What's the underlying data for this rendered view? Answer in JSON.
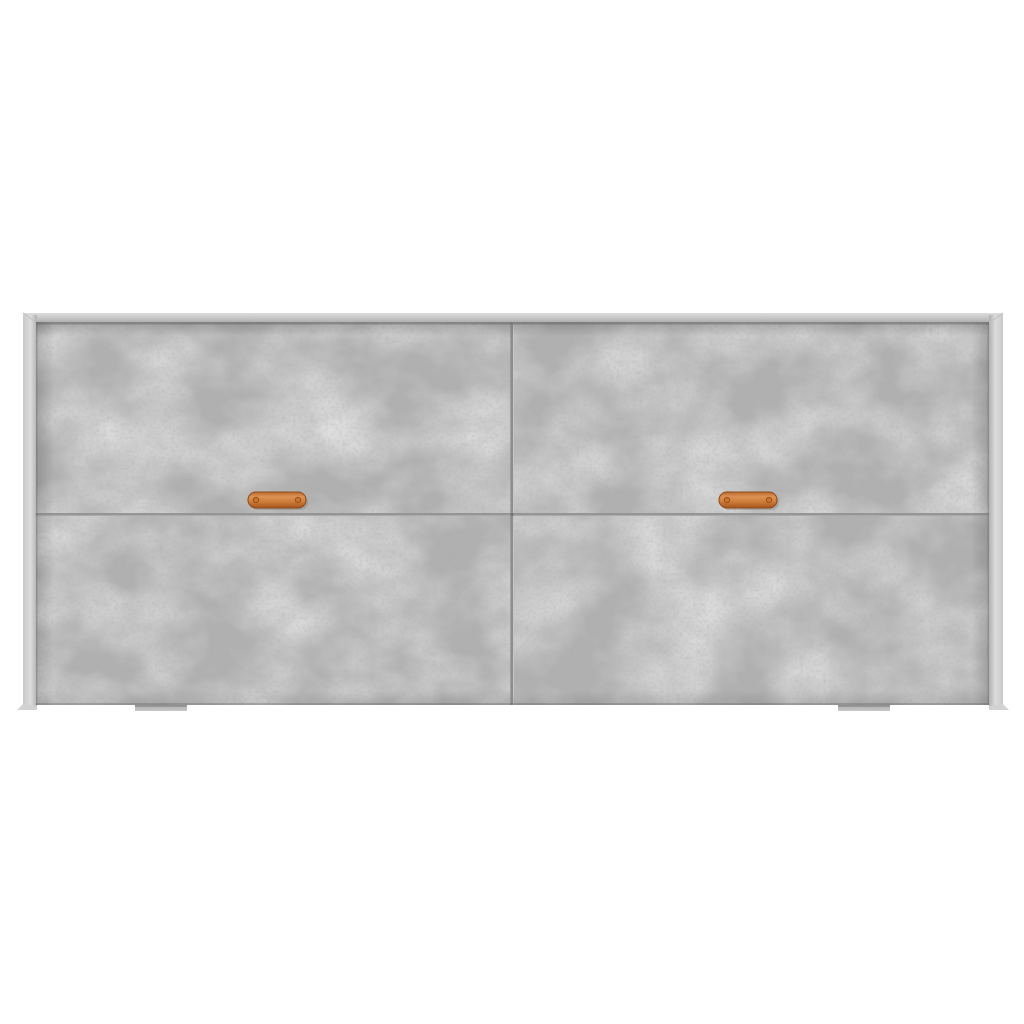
{
  "image": {
    "kind": "product-photo",
    "subject": "sideboard cabinet, concrete-gray finish, front view on plain white background",
    "details": {
      "panel_rows": 2,
      "panel_columns": 2,
      "handle_count": 2,
      "handle_style": "copper strap pull with end screws",
      "feet_count": 2
    }
  },
  "palette": {
    "background": "#ffffff",
    "frame_top_light": "#dcdcdc",
    "frame_mid": "#c9c9c9",
    "frame_dark": "#b0b0b0",
    "panel_base": "#b0b0b0",
    "seam": "#686868",
    "handle_body": "#cf7d39",
    "handle_light": "#dd9254",
    "handle_dark": "#a5551d",
    "handle_outline": "#8f4a19",
    "screw": "#c6752f",
    "foot": "#b7b7b7",
    "foot_edge": "#8f8f8f",
    "shadow": "#000000"
  }
}
